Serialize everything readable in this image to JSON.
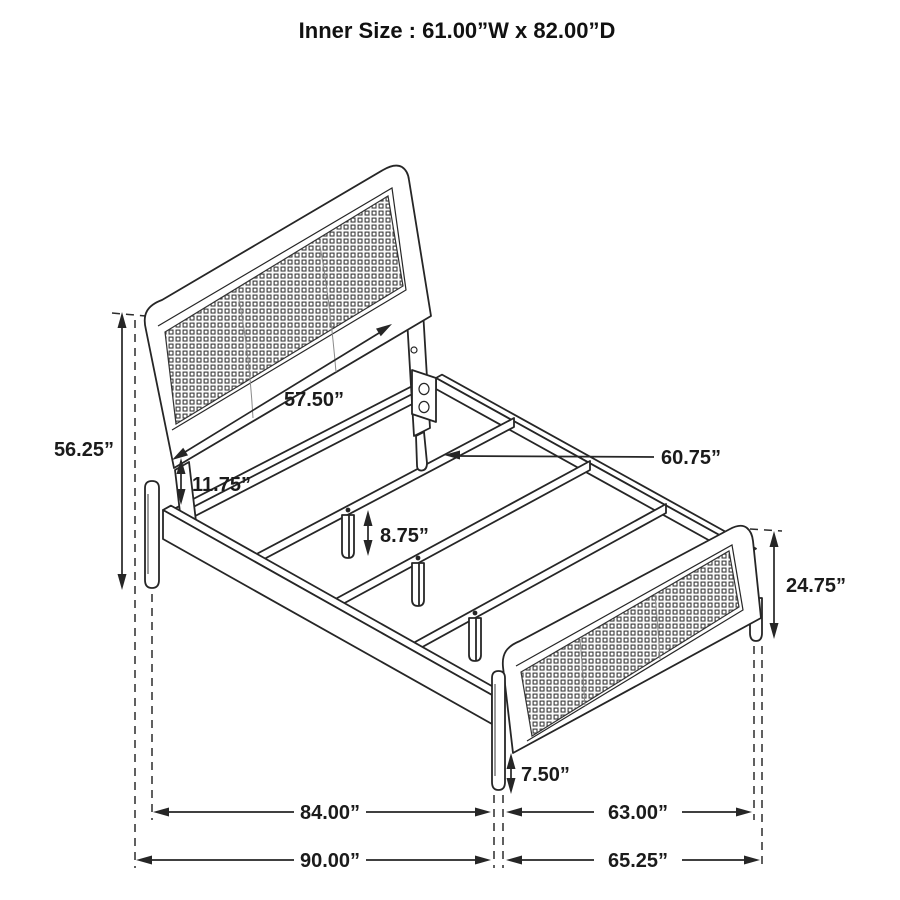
{
  "title": "Inner Size : 61.00”W x 82.00”D",
  "diagram_type": "bed frame dimension drawing",
  "colors": {
    "background": "#ffffff",
    "line": "#262626",
    "text": "#1b1b1b"
  },
  "dimension_labels": {
    "headboard_width": "57.50”",
    "headboard_height": "56.25”",
    "headboard_rail_gap": "11.75”",
    "center_support_leg_height": "8.75”",
    "slat_length": "60.75”",
    "footboard_height": "24.75”",
    "footboard_leg_height": "7.50”",
    "inner_frame_depth": "84.00”",
    "overall_depth": "90.00”",
    "footboard_width": "63.00”",
    "overall_width": "65.25”"
  }
}
